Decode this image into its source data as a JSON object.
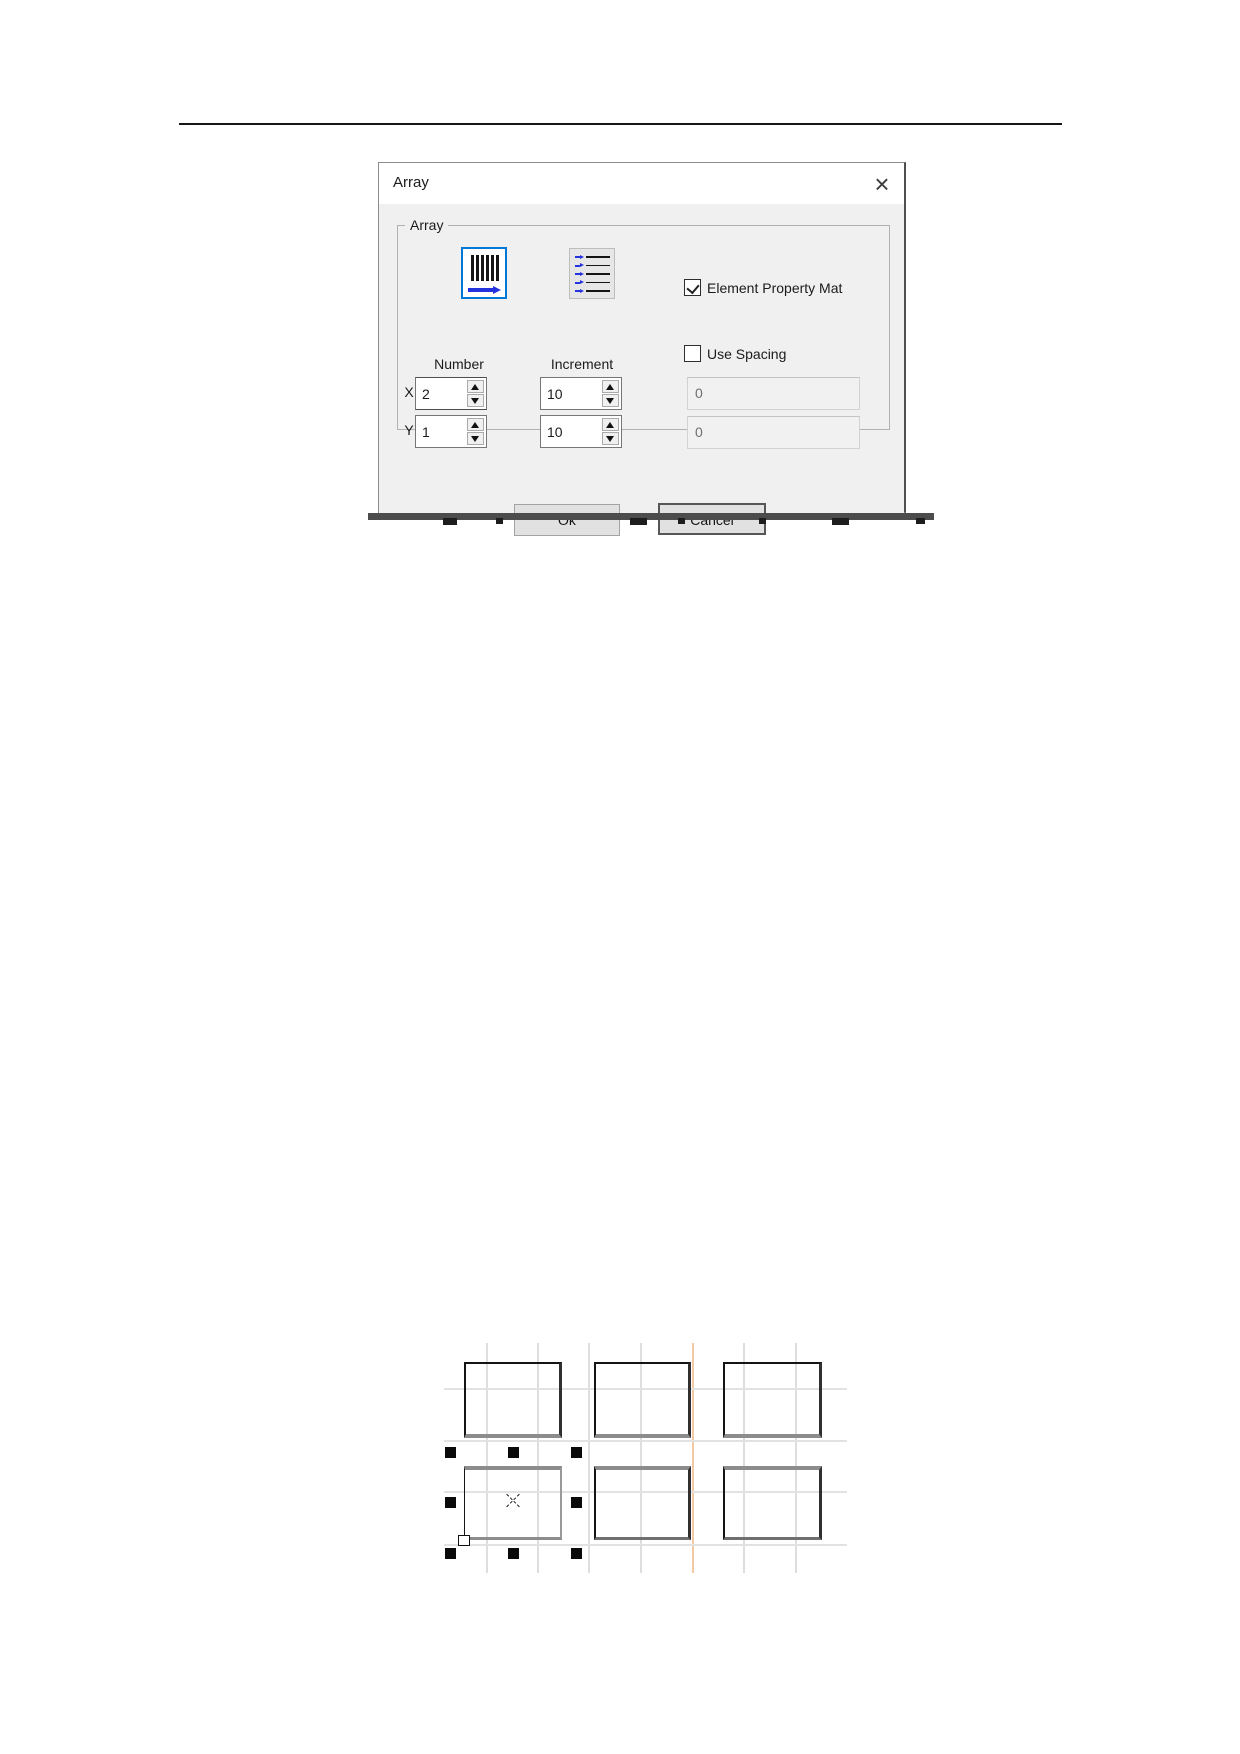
{
  "dialog": {
    "title": "Array",
    "close_glyph": "×",
    "group_label": "Array",
    "accent_color": "#0078d7",
    "icons": {
      "x_array_icon": "vertical-bars-with-right-arrow",
      "y_array_icon": "horizontal-lines-with-right-arrows"
    },
    "number_label": "Number",
    "increment_label": "Increment",
    "x_label": "X",
    "y_label": "Y",
    "x_number": "2",
    "y_number": "1",
    "x_increment": "10",
    "y_increment": "10",
    "x_spacing": "0",
    "y_spacing": "0",
    "element_property": {
      "label": "Element Property Mat",
      "checked": true
    },
    "use_spacing": {
      "label": "Use Spacing",
      "checked": false
    },
    "ok_label": "Ok",
    "cancel_label": "Cancel"
  },
  "figure": {
    "grid": {
      "v_lines_x": [
        487,
        538,
        589,
        641,
        693,
        744,
        796
      ],
      "orange_line_x": 693,
      "v_extent": [
        1343,
        1573
      ],
      "h_lines_y": [
        1389,
        1441,
        1492,
        1545
      ],
      "h_extent": [
        444,
        847
      ],
      "line_color": "#dedede",
      "orange_color": "#f3c9a4"
    },
    "rectangles": [
      {
        "x": 464,
        "y": 1362,
        "w": 98,
        "h": 76,
        "row": 1,
        "selected": false
      },
      {
        "x": 594,
        "y": 1362,
        "w": 97,
        "h": 76,
        "row": 1,
        "selected": false
      },
      {
        "x": 723,
        "y": 1362,
        "w": 99,
        "h": 76,
        "row": 1,
        "selected": false
      },
      {
        "x": 464,
        "y": 1466,
        "w": 98,
        "h": 74,
        "row": 2,
        "selected": true
      },
      {
        "x": 594,
        "y": 1466,
        "w": 97,
        "h": 74,
        "row": 2,
        "selected": false
      },
      {
        "x": 723,
        "y": 1466,
        "w": 99,
        "h": 74,
        "row": 2,
        "selected": false
      }
    ],
    "selection_handles": [
      [
        450,
        1452
      ],
      [
        513,
        1452
      ],
      [
        576,
        1452
      ],
      [
        450,
        1502
      ],
      [
        576,
        1502
      ],
      [
        450,
        1553
      ],
      [
        513,
        1553
      ],
      [
        576,
        1553
      ]
    ],
    "x_marker": {
      "x": 513,
      "y": 1501
    },
    "anchor": {
      "x": 458,
      "y": 1535
    }
  },
  "artifacts": {
    "strip_color": "#4c4c4c",
    "marks": [
      [
        443,
        518,
        14,
        7
      ],
      [
        496,
        518,
        7,
        6
      ],
      [
        630,
        518,
        17,
        7
      ],
      [
        678,
        518,
        7,
        6
      ],
      [
        759,
        518,
        7,
        6
      ],
      [
        832,
        518,
        17,
        7
      ],
      [
        916,
        518,
        9,
        6
      ]
    ]
  }
}
